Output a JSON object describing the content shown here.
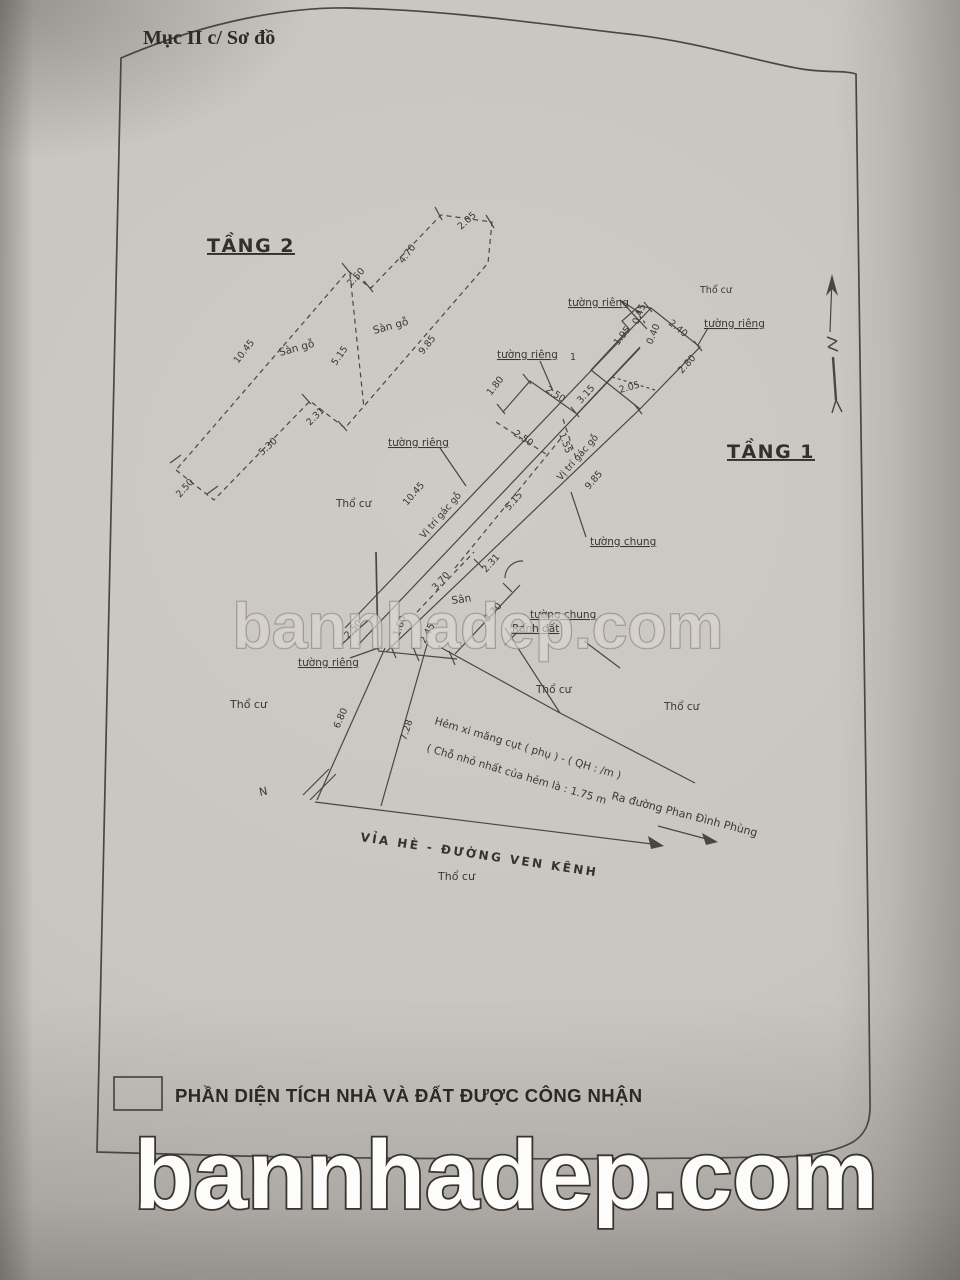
{
  "page": {
    "section_title": "Mục II c/ Sơ đồ",
    "legend": {
      "label": "PHẦN DIỆN TÍCH NHÀ VÀ ĐẤT ĐƯỢC CÔNG NHẬN"
    },
    "watermark_text": "bannhadep.com"
  },
  "shared_labels": {
    "tuong_rieng": "tường riêng",
    "tuong_chung": "tường chung",
    "vi_tri_gac_go": "Vị trí gác gỗ",
    "tho_cu": "Thổ cư",
    "ranh_dat": "Ranh đất",
    "san_go": "Sàn gỗ",
    "san": "Sân",
    "north": "N",
    "one": "1"
  },
  "floor2": {
    "title": "TẦNG 2",
    "dims": {
      "left_long": "10.45",
      "bottom_inner": "5.30",
      "bottom_end": "2.50",
      "step_bottom": "2.31",
      "divider": "5.15",
      "step_top": "2.50",
      "top_upper": "4.70",
      "tip": "2.05",
      "right_long": "9.85"
    }
  },
  "floor1": {
    "title": "TẦNG 1",
    "dims": {
      "gac_long": "10.45",
      "divider": "5.15",
      "wall_right": "9.85",
      "mid_side": "1.80",
      "mid_width": "2.50",
      "mid_upper": "3.15",
      "mid_dash": "2.50",
      "mid_dash2": "1.55",
      "upper_left": "1.95",
      "notch_a": "0.45",
      "notch_b": "0.40",
      "top_width": "2.40",
      "top_side": "2.80",
      "top_dash": "2.05",
      "yard_step": "2.31",
      "yard_a": "3.70",
      "yard_b": "3.70",
      "bl_end": "2.50",
      "bl_a": "1.60",
      "bl_b": "2.45",
      "hem_a": "6.80",
      "hem_b": "7.28"
    }
  },
  "annotations": {
    "hem_line1": "Hẻm xi măng cụt ( phụ ) - ( QH : /m )",
    "hem_line2": "( Chỗ nhỏ nhất của hẻm là : 1.75 m",
    "ra_duong": "Ra đường Phan Đình Phùng",
    "via_he": "VỈA HÈ - ĐƯỜNG VEN KÊNH"
  }
}
